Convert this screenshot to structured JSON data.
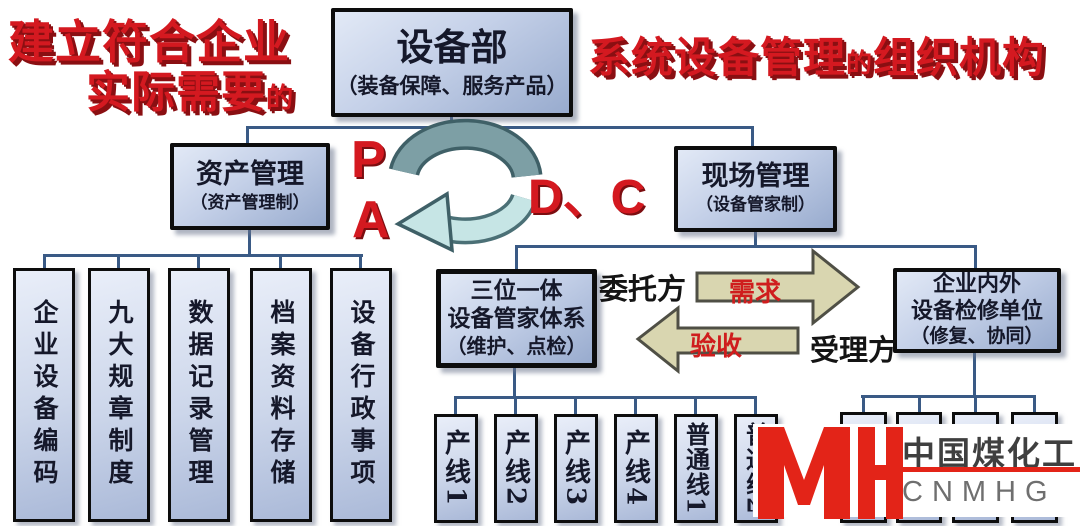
{
  "colors": {
    "red_accent": "#d41920",
    "logo_red": "#e32418",
    "box_border": "#0d0d0d",
    "box_fill_light": "#e2e9f6",
    "box_fill_dark": "#98abce",
    "connector": "#3a5a85",
    "arrow_fill": "#d9d6b0",
    "ribbon_dark": "#7d9fa5",
    "ribbon_light": "#c6e5e5"
  },
  "headings": {
    "left_line1": "建立符合企业",
    "left_line2": "实际需要",
    "left_small": "的",
    "right_part1": "系统设备管理",
    "right_small": "的",
    "right_part2": "组织机构"
  },
  "dept": {
    "title": "设备部",
    "subtitle": "（装备保障、服务产品）"
  },
  "asset": {
    "title": "资产管理",
    "subtitle": "（资产管理制）",
    "children": [
      "企业设备编码",
      "九大规章制度",
      "数据记录管理",
      "档案资料存储",
      "设备行政事项"
    ]
  },
  "site": {
    "title": "现场管理",
    "subtitle": "（设备管家制）"
  },
  "trinity": {
    "line1": "三位一体",
    "line2": "设备管家体系",
    "line3": "（维护、点检）"
  },
  "repair": {
    "line1": "企业内外",
    "line2": "设备检修单位",
    "line3": "（修复、协同）"
  },
  "production_lines": [
    "产线1",
    "产线2",
    "产线3",
    "产线4",
    "普通线1",
    "普通线2"
  ],
  "pdca": {
    "p": "P",
    "a": "A",
    "dc": "D、C"
  },
  "relation": {
    "entrust": "委托方",
    "demand": "需求",
    "accept": "验收",
    "handle": "受理方"
  },
  "logo": {
    "monogram": "MH",
    "name": "中国煤化工",
    "abbr": "CNMHG"
  }
}
